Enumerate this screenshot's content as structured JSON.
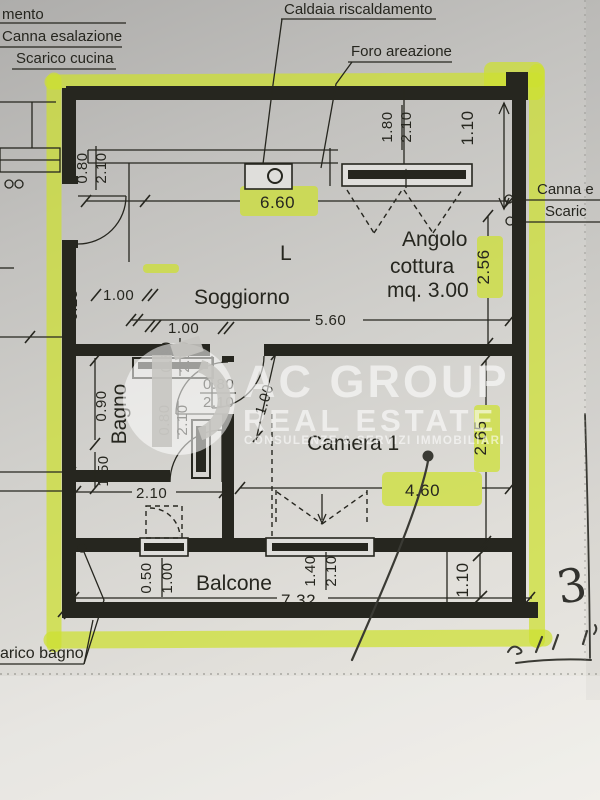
{
  "colors": {
    "paper_light": "#edebe5",
    "paper_dark": "#b0afac",
    "ink": "#26261f",
    "highlighter": "#cde02f",
    "pen": "#3a3a34",
    "watermark": "#ffffff"
  },
  "callouts": {
    "heating_partial": "mento",
    "flue": "Canna esalazione",
    "kitchen_drain": "Scarico cucina",
    "boiler": "Caldaia riscaldamento",
    "vent_hole": "Foro areazione",
    "flue_right": "Canna e",
    "drain_right": "Scaric",
    "bath_drain": "arico bagno"
  },
  "rooms": {
    "living": "Soggiorno",
    "kitchen_1": "Angolo",
    "kitchen_2": "cottura",
    "kitchen_3": "mq. 3.00",
    "bedroom": "Camera 1",
    "bath": "Bagno",
    "balcony": "Balcone",
    "letter": "L"
  },
  "dimensions": {
    "living_width": "6.60",
    "living_width_inner": "5.60",
    "entry_a": "1.00",
    "entry_b": "1.00",
    "wall_thickness": "0.25",
    "entry_door_w": "0.80",
    "entry_door_h": "2.10",
    "kitchen_win_w": "1.80",
    "kitchen_win_h": "2.10",
    "top_right": "1.10",
    "kitchen_depth": "2.56",
    "bedroom_depth": "2.65",
    "bedroom_width": "4.60",
    "balcony_depth": "1.10",
    "balcony_width": "7.32",
    "bath_width": "2.10",
    "bath_a": "0.90",
    "bath_b": "1.50",
    "bath_door1_w": "0.80",
    "bath_door1_h": "2.10",
    "bath_door2_w": "0.80",
    "bath_door2_h": "2.10",
    "bedroom_door_w": "0.80",
    "bedroom_door_h": "2.10",
    "bedroom_diag": "1.00",
    "balcony_win_small_w": "0.50",
    "balcony_win_small_h": "1.00",
    "balcony_win_large_w": "1.40",
    "balcony_win_large_h": "2.10"
  },
  "watermark": {
    "brand_top": "AC GROUP",
    "brand_bottom": "REAL ESTATE",
    "tagline": "CONSULENZE & SERVIZI IMMOBILIARI"
  },
  "pen_notes": {
    "number": "3"
  }
}
